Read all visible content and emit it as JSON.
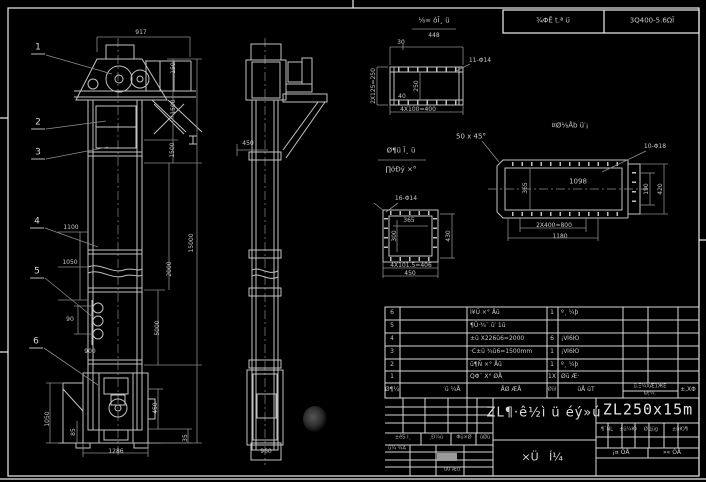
{
  "stamp": {
    "left": "¾ΦĒ t.ª ü",
    "right": "3Q400-5.6ΩΪ"
  },
  "balloons": [
    "1",
    "2",
    "3",
    "4",
    "5",
    "6"
  ],
  "front_view": {
    "dims": {
      "d917": "917",
      "d150": "150",
      "d1500a": "1500",
      "d1500b": "1500",
      "d15000": "15000",
      "d1100": "1100",
      "d1050": "1050",
      "d2000": "2000",
      "d5000": "5000",
      "d90": "90",
      "d900": "900",
      "d1050b": "1050",
      "d85": "85",
      "d450": "450",
      "d35": "35",
      "d1286": "1286"
    }
  },
  "side_view": {
    "dims": {
      "d450": "450",
      "d960": "960"
    }
  },
  "detail_a": {
    "title": "⅛∞ óĪ¸ ü",
    "scale": "448",
    "holes": "11-Φ14",
    "dims": {
      "d30": "30",
      "left": "2X125=250",
      "inner": "250",
      "d40": "40",
      "bottom": "4X100=400"
    }
  },
  "detail_b": {
    "title": "¤Ø⅛Åb ü′¡",
    "chamfer": "50 x 45°",
    "holes": "10-Φ18",
    "dims": {
      "inner_len": "1098",
      "inner_h": "365",
      "pitch": "2X400=800",
      "total": "1180",
      "r_inner": "190",
      "r_outer": "420"
    }
  },
  "detail_c": {
    "title1": "Ø¶ü Ī¸ ü",
    "title2": "∏óĐý ×°",
    "holes": "16-Φ14",
    "dims": {
      "width": "365",
      "height": "300",
      "pitch": "4X101.5=406",
      "total": "450",
      "right": "430"
    }
  },
  "bom": {
    "headers": {
      "no": "Ø¶¼",
      "dwg": "′ū ¼Å",
      "name": "ÅØ ÆÅ",
      "qty": "Øūl",
      "mat": "ūÅ ūT",
      "w1": "ū.Ξ¼XÆ1ЖЕ",
      "w2": "Ø¦¼.",
      "rem": "±,XΦ"
    },
    "rows": [
      {
        "no": "6",
        "desc": "Ì¥Ü ×° Åū",
        "qty": "1",
        "mat": "º¸ ¼þ"
      },
      {
        "no": "5",
        "desc": "¶Ū·¾¨ ū′ 1ū",
        "qty": "",
        "mat": ""
      },
      {
        "no": "4",
        "desc": "±ū X226ū6=2000",
        "qty": "6",
        "mat": "¡Ⅵ6Ю"
      },
      {
        "no": "3",
        "desc": "·C±ū ¾ū6=1500mm",
        "qty": "1",
        "mat": "¡Ⅵ6Ю"
      },
      {
        "no": "2",
        "desc": "ū¶Ñ ×° Åū",
        "qty": "1",
        "mat": "º¸ ¼þ"
      },
      {
        "no": "1",
        "desc": "QΦ¨ X° ØÅ",
        "qty": "1X",
        "mat": "Øū Æ·"
      }
    ]
  },
  "title_block": {
    "model": "ZL250x15m",
    "title": "ZL¶·ê½ì ü éý»ú",
    "type1": "×Ü",
    "type2": "Í¼",
    "rh1": "¶¨ÑL",
    "rh2": "±ü¼Ю",
    "rh3": "ØЦüg",
    "rh4": "±üЮ¶",
    "sheet_l": "¡¤ ÓÅ",
    "sheet_r": "»« ÓÅ",
    "lh1": "±êƼ Ι¸",
    "lh2": "¸Đ¼ü",
    "lh3": "Φü×Ø",
    "lh4": "ūØü",
    "s1": "ü¼ ¾Å",
    "s2": "üü Æū"
  }
}
